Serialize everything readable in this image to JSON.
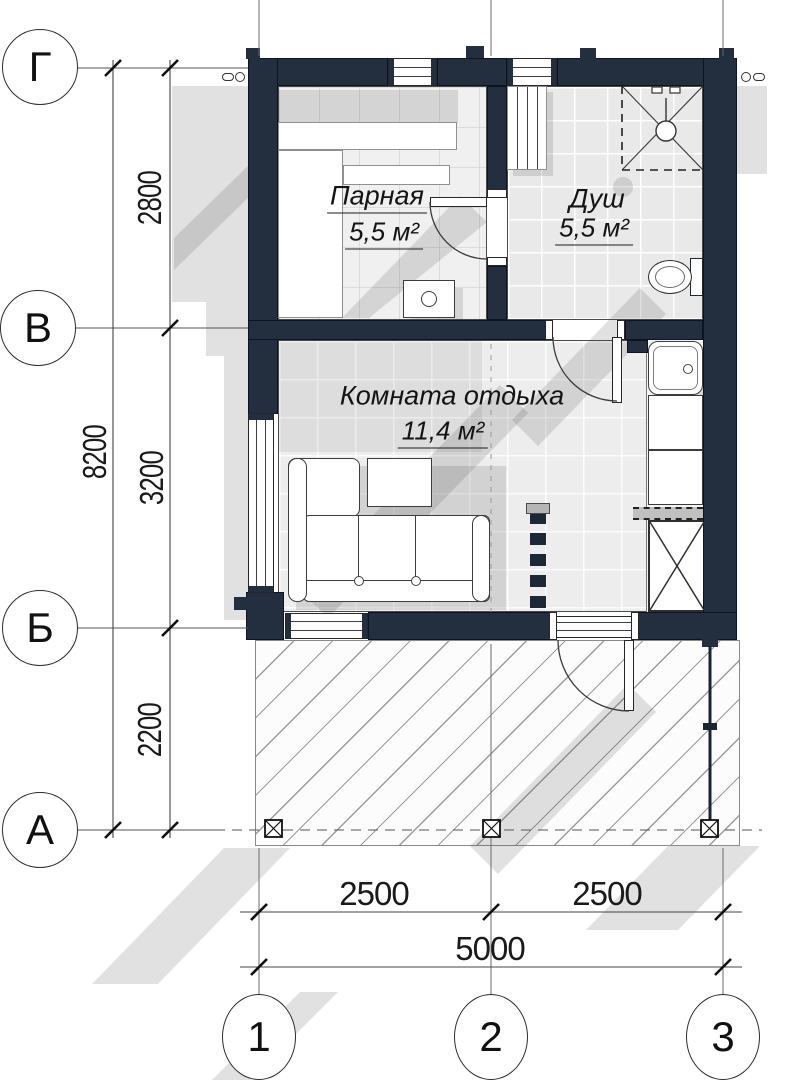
{
  "drawing": {
    "type": "floor-plan",
    "rooms": [
      {
        "name": "Парная",
        "area": "5,5 м²"
      },
      {
        "name": "Душ",
        "area": "5,5 м²"
      },
      {
        "name": "Комната отдыха",
        "area": "11,4 м²"
      }
    ],
    "axes": {
      "rows": [
        {
          "label": "Г"
        },
        {
          "label": "В"
        },
        {
          "label": "Б"
        },
        {
          "label": "А"
        }
      ],
      "cols": [
        {
          "label": "1"
        },
        {
          "label": "2"
        },
        {
          "label": "3"
        }
      ]
    },
    "dimensions": {
      "left_spans": [
        "2800",
        "3200",
        "2200"
      ],
      "left_total": "8200",
      "bottom_spans": [
        "2500",
        "2500"
      ],
      "bottom_total": "5000"
    },
    "colors": {
      "wall": "#232e3e",
      "wall_outline": "#0c1322",
      "tile": "#e9e9e9",
      "shadow": "rgba(70,70,70,0.16)",
      "hatch_line": "#9b9b9b",
      "background": "#ffffff"
    },
    "symbols": [
      "shower-cabin-icon",
      "shower-head-icon",
      "toilet-icon",
      "sink-icon",
      "stove-icon",
      "sauna-heater-icon",
      "sofa-icon",
      "table-icon",
      "bench-icon",
      "post-icon",
      "door-icon",
      "window-icon"
    ]
  }
}
